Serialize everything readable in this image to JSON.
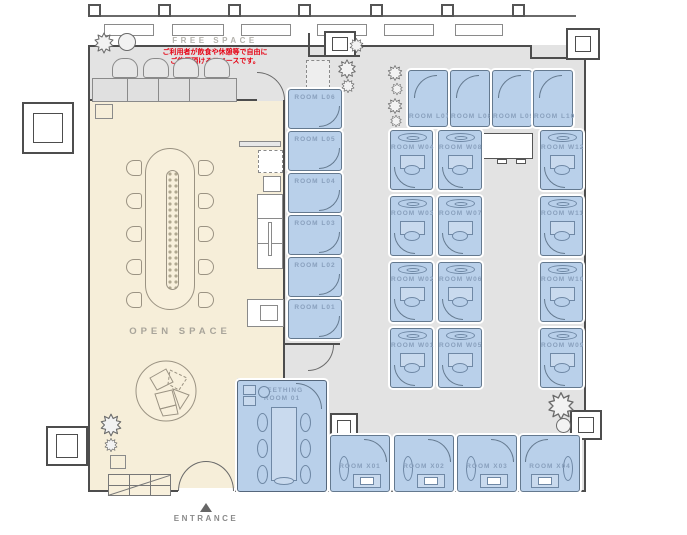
{
  "labels": {
    "free_space": "FREE SPACE",
    "free_space_note_line1": "ご利用者が飲食や休憩等で自由に",
    "free_space_note_line2": "ご使用頂けるスペースです。",
    "open_space": "OPEN SPACE",
    "entrance": "ENTRANCE",
    "entrance_arrow": "▲",
    "meeting_room_line1": "MEETHING",
    "meeting_room_line2": "ROOM 01"
  },
  "rooms": {
    "l_col": [
      "ROOM L06",
      "ROOM L05",
      "ROOM L04",
      "ROOM L03",
      "ROOM L02",
      "ROOM L01"
    ],
    "l_row": [
      "ROOM L07",
      "ROOM L08",
      "ROOM L09",
      "ROOM L10"
    ],
    "w": [
      "ROOM W04",
      "ROOM W08",
      "ROOM W12",
      "ROOM W03",
      "ROOM W07",
      "ROOM W11",
      "ROOM W02",
      "ROOM W06",
      "ROOM W10",
      "ROOM W01",
      "ROOM W05",
      "ROOM W09"
    ],
    "x_row": [
      "ROOM X01",
      "ROOM X02",
      "ROOM X03",
      "ROOM X04"
    ]
  },
  "colors": {
    "room_fill": "#b9d0ea",
    "room_border": "#64798f",
    "corridor_gray": "#e3e3e3",
    "open_space_beige": "#f6eed9",
    "wall": "#4d4d4d",
    "room_label": "#89a0bd",
    "space_label_gray": "#b4b2ac",
    "open_space_label": "#a8a49a",
    "note_red": "#e60012"
  }
}
